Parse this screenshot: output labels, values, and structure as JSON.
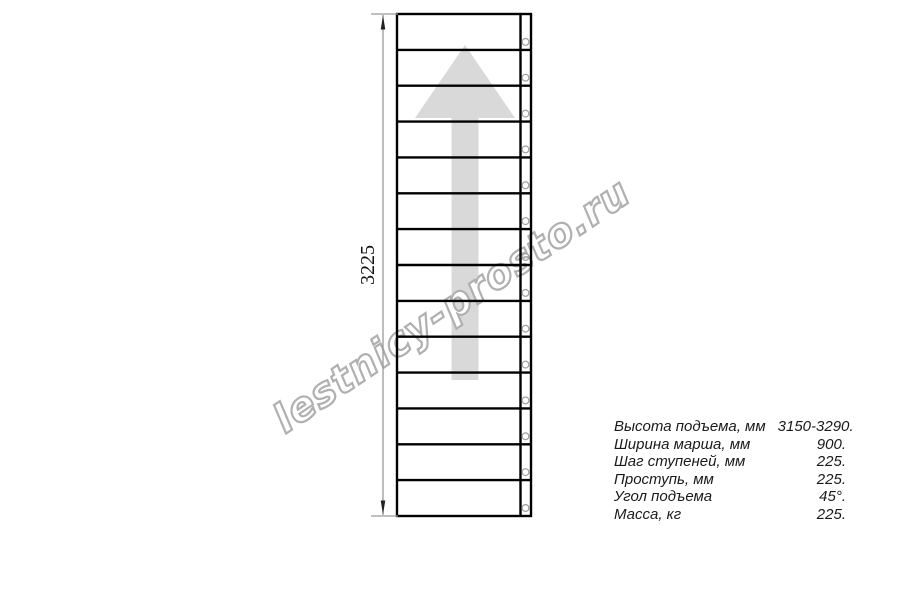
{
  "page": {
    "background": "#ffffff",
    "width": 900,
    "height": 600
  },
  "drawing": {
    "type": "staircase-plan-view",
    "dimension_label": "3225",
    "steps_count": 14,
    "bolt_holes_count": 14,
    "direction_arrow": "up",
    "colors": {
      "outline": "#000000",
      "dimension_line": "#999999",
      "dimension_arrowhead": "#222222",
      "direction_arrow_fill": "#d9d9d9",
      "bolt_hole_stroke": "#9e9e9e"
    }
  },
  "watermark": {
    "text": "lestnicy-prosto.ru",
    "stroke_color": "#b0b0b0",
    "fill_color": "#ffffff"
  },
  "specs": {
    "rows": [
      {
        "label": "Высота подъема, мм",
        "value": "3150-3290."
      },
      {
        "label": "Ширина марша, мм",
        "value": "900."
      },
      {
        "label": "Шаг ступеней, мм",
        "value": "225."
      },
      {
        "label": "Проступь, мм",
        "value": "225."
      },
      {
        "label": "Угол подъема",
        "value": "45°."
      },
      {
        "label": "Масса, кг",
        "value": "225."
      }
    ]
  }
}
